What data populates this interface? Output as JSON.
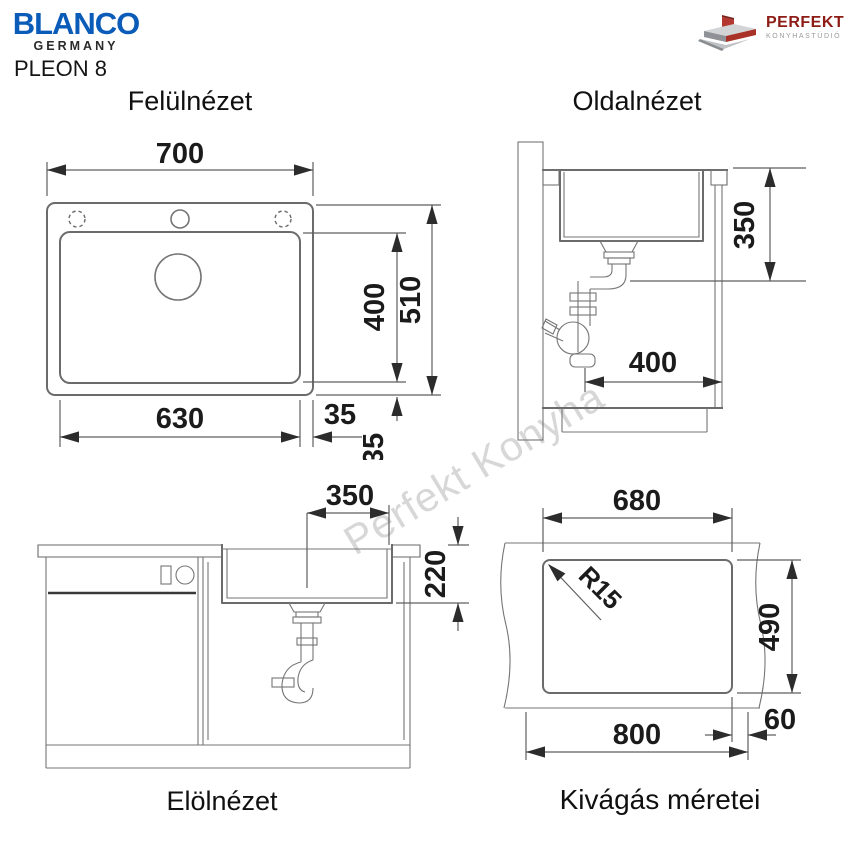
{
  "header": {
    "brand": "BLANCO",
    "brand_sub": "GERMANY",
    "model": "PLEON 8",
    "partner": "PERFEKT",
    "partner_sub": "KONYHASTÚDIÓ"
  },
  "watermark": {
    "text": "Perfekt Konyha"
  },
  "views": {
    "top": {
      "title": "Felülnézet",
      "dims": {
        "width": "700",
        "bowl_height": "400",
        "height": "510",
        "bowl_width": "630",
        "edge_right": "35",
        "edge_bottom": "35"
      }
    },
    "side": {
      "title": "Oldalnézet",
      "dims": {
        "depth": "350",
        "drain_offset": "400"
      }
    },
    "front": {
      "title": "Elölnézet",
      "dims": {
        "center_to_edge": "350",
        "depth": "220"
      }
    },
    "cutout": {
      "title": "Kivágás méretei",
      "dims": {
        "width": "680",
        "corner_radius": "R15",
        "height": "490",
        "total_width": "800",
        "edge": "60"
      }
    }
  },
  "colors": {
    "brand_blue": "#0a5cb8",
    "partner_red": "#8e1c16",
    "line_gray": "#6b6b6b",
    "dim_text": "#1b1b1b",
    "watermark_gray": "#d7d7d7"
  }
}
